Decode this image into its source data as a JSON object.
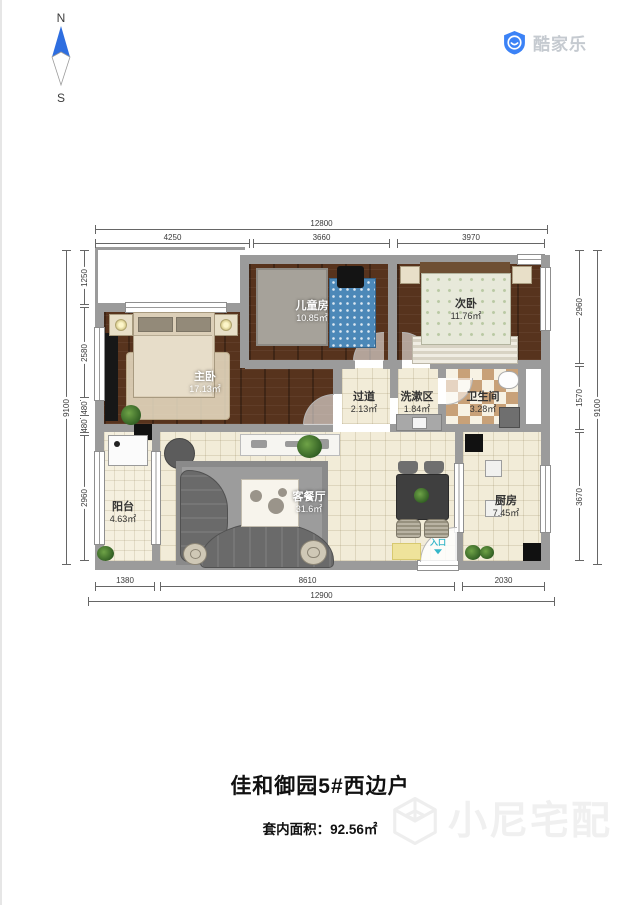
{
  "compass": {
    "north": "N",
    "south": "S"
  },
  "logo": {
    "brand": "酷家乐"
  },
  "dimensions": {
    "top": {
      "overall": "12800",
      "segments": [
        "4250",
        "3660",
        "3970"
      ]
    },
    "bottom": {
      "overall": "12900",
      "segments": [
        "1380",
        "8610",
        "2030"
      ]
    },
    "left": {
      "overall": "9100",
      "segments": [
        "1250",
        "2580",
        "480",
        "480",
        "2960"
      ]
    },
    "right": {
      "overall": "9100",
      "segments": [
        "2960",
        "1570",
        "3670"
      ]
    }
  },
  "rooms": [
    {
      "name": "主卧",
      "area": "17.13㎡"
    },
    {
      "name": "儿童房",
      "area": "10.85㎡"
    },
    {
      "name": "次卧",
      "area": "11.76㎡"
    },
    {
      "name": "过道",
      "area": "2.13㎡"
    },
    {
      "name": "洗漱区",
      "area": "1.84㎡"
    },
    {
      "name": "卫生间",
      "area": "3.28㎡"
    },
    {
      "name": "阳台",
      "area": "4.63㎡"
    },
    {
      "name": "客餐厅",
      "area": "31.6㎡"
    },
    {
      "name": "厨房",
      "area": "7.45㎡"
    }
  ],
  "entry": {
    "label": "入口"
  },
  "footer": {
    "title": "佳和御园5#西边户",
    "area_text": "套内面积：92.56㎡"
  },
  "watermark": {
    "brand": "小尼宅配"
  },
  "colors": {
    "accent_blue": "#3b82f6",
    "entry_teal": "#35b6c9",
    "wall_gray": "#9b9b9b",
    "wood_brown": "#57331d",
    "tile_cream": "#f2ecd8"
  }
}
